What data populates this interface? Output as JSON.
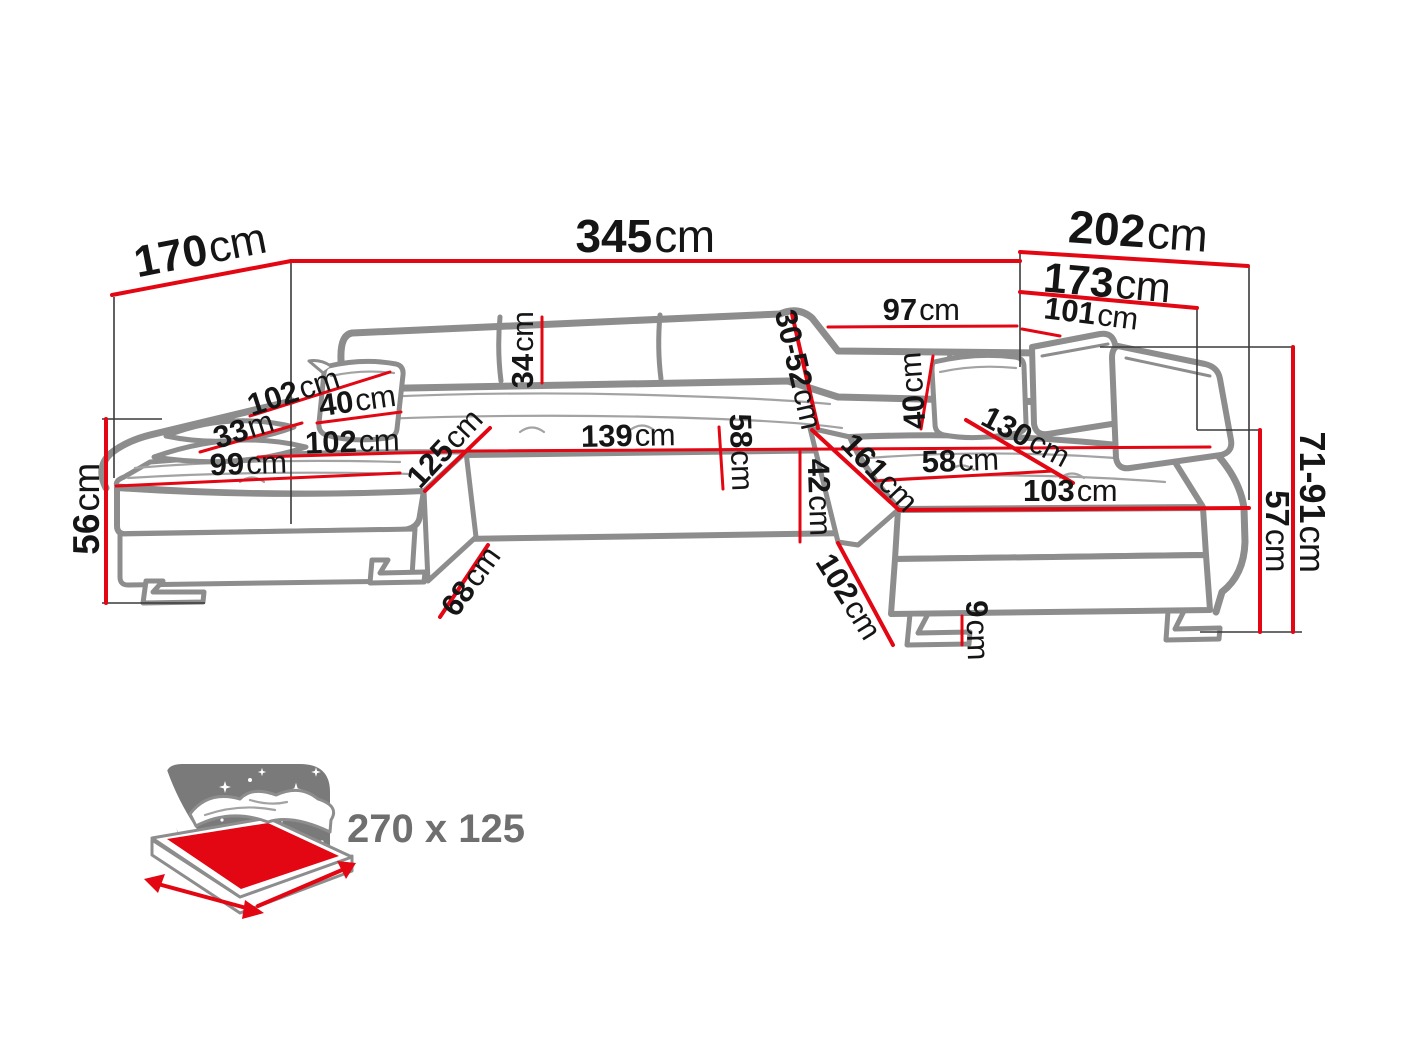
{
  "diagram_title": "corner-sofa-dimension-diagram",
  "colors": {
    "accent": "#e30613",
    "sketch": "#8d8d8d",
    "ink": "#151515",
    "bed_text": "#6f6f6f",
    "star_panel": "#7a7a7a"
  },
  "dimensions": {
    "depth_left": {
      "v": "170",
      "u": "cm"
    },
    "width_total": {
      "v": "345",
      "u": "cm"
    },
    "width_right": {
      "v": "202",
      "u": "cm"
    },
    "width_right_inner": {
      "v": "173",
      "u": "cm"
    },
    "back_right_a": {
      "v": "97",
      "u": "cm"
    },
    "back_right_b": {
      "v": "101",
      "u": "cm"
    },
    "arm_left_top": {
      "v": "102",
      "u": "cm"
    },
    "arm_left_width": {
      "v": "33",
      "u": "m"
    },
    "pillow_left": {
      "v": "40",
      "u": "cm"
    },
    "seat_left_depth": {
      "v": "102",
      "u": "cm"
    },
    "chaise_left_width": {
      "v": "99",
      "u": "cm"
    },
    "chaise_left_inner": {
      "v": "125",
      "u": "cm"
    },
    "backrest_height": {
      "v": "34",
      "u": "cm"
    },
    "seat_mid_width": {
      "v": "139",
      "u": "cm"
    },
    "seat_mid_depth": {
      "v": "58",
      "u": "cm"
    },
    "back_adjust_range": {
      "v": "30-52",
      "u": "cm"
    },
    "pillow_right": {
      "v": "40",
      "u": "cm"
    },
    "chaise_right_length": {
      "v": "161",
      "u": "cm"
    },
    "seat_right_depth": {
      "v": "58",
      "u": "cm"
    },
    "chaise_right_diag": {
      "v": "130",
      "u": "cm"
    },
    "chaise_right_width": {
      "v": "103",
      "u": "cm"
    },
    "height_left": {
      "v": "56",
      "u": "cm"
    },
    "front_height": {
      "v": "42",
      "u": "cm"
    },
    "well_left": {
      "v": "68",
      "u": "cm"
    },
    "well_right": {
      "v": "102",
      "u": "cm"
    },
    "leg_height": {
      "v": "9",
      "u": "cm"
    },
    "height_right": {
      "v": "71-91",
      "u": "cm"
    },
    "height_seat_back": {
      "v": "57",
      "u": "cm"
    }
  },
  "bed": {
    "size_label": "270 x 125"
  }
}
